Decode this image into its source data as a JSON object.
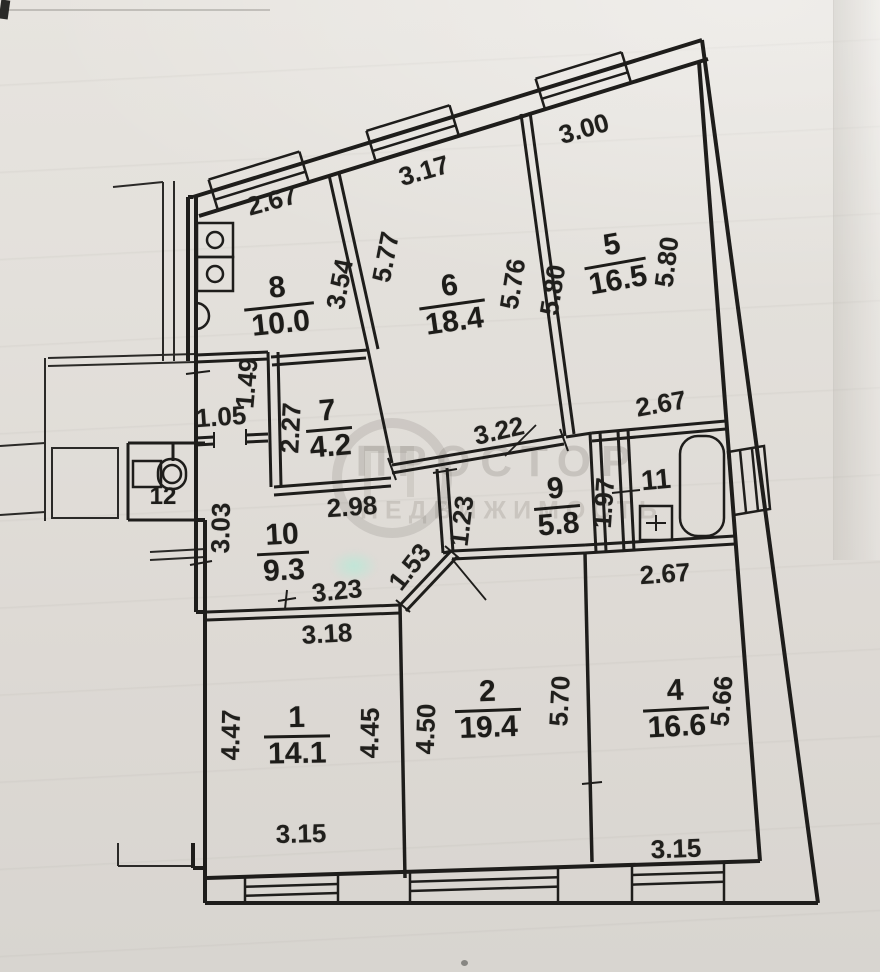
{
  "document_type": "apartment floor plan scan",
  "watermark": {
    "line1": "ПРОСТОР",
    "line2": "НЕДВИЖИМОСТЬ"
  },
  "icons": [
    "bathtub-icon",
    "toilet-icon",
    "sink-icon",
    "stove-icon",
    "vent-shaft-icon",
    "window-symbol",
    "door-leaf-icon"
  ],
  "plan": {
    "rooms": {
      "r1": {
        "number": "1",
        "area": "14.1"
      },
      "r2": {
        "number": "2",
        "area": "19.4"
      },
      "r4": {
        "number": "4",
        "area": "16.6"
      },
      "r5": {
        "number": "5",
        "area": "16.5"
      },
      "r6": {
        "number": "6",
        "area": "18.4"
      },
      "r7": {
        "number": "7",
        "area": "4.2"
      },
      "r8": {
        "number": "8",
        "area": "10.0"
      },
      "r9": {
        "number": "9",
        "area": "5.8"
      },
      "r10": {
        "number": "10",
        "area": "9.3"
      },
      "r11": {
        "number": "11"
      },
      "r12": {
        "number": "12"
      }
    },
    "dimensions": [
      {
        "text": "2.67"
      },
      {
        "text": "3.17"
      },
      {
        "text": "3.00"
      },
      {
        "text": "3.54"
      },
      {
        "text": "5.77"
      },
      {
        "text": "5.76"
      },
      {
        "text": "5.80"
      },
      {
        "text": "5.80"
      },
      {
        "text": "1.49"
      },
      {
        "text": "1.05"
      },
      {
        "text": "2.27"
      },
      {
        "text": "2.98"
      },
      {
        "text": "3.22"
      },
      {
        "text": "2.67"
      },
      {
        "text": "1.23"
      },
      {
        "text": "1.97"
      },
      {
        "text": "3.03"
      },
      {
        "text": "1.53"
      },
      {
        "text": "3.23"
      },
      {
        "text": "3.18"
      },
      {
        "text": "2.67"
      },
      {
        "text": "4.47"
      },
      {
        "text": "4.45"
      },
      {
        "text": "4.50"
      },
      {
        "text": "5.70"
      },
      {
        "text": "5.66"
      },
      {
        "text": "3.15"
      },
      {
        "text": "3.15"
      }
    ]
  }
}
